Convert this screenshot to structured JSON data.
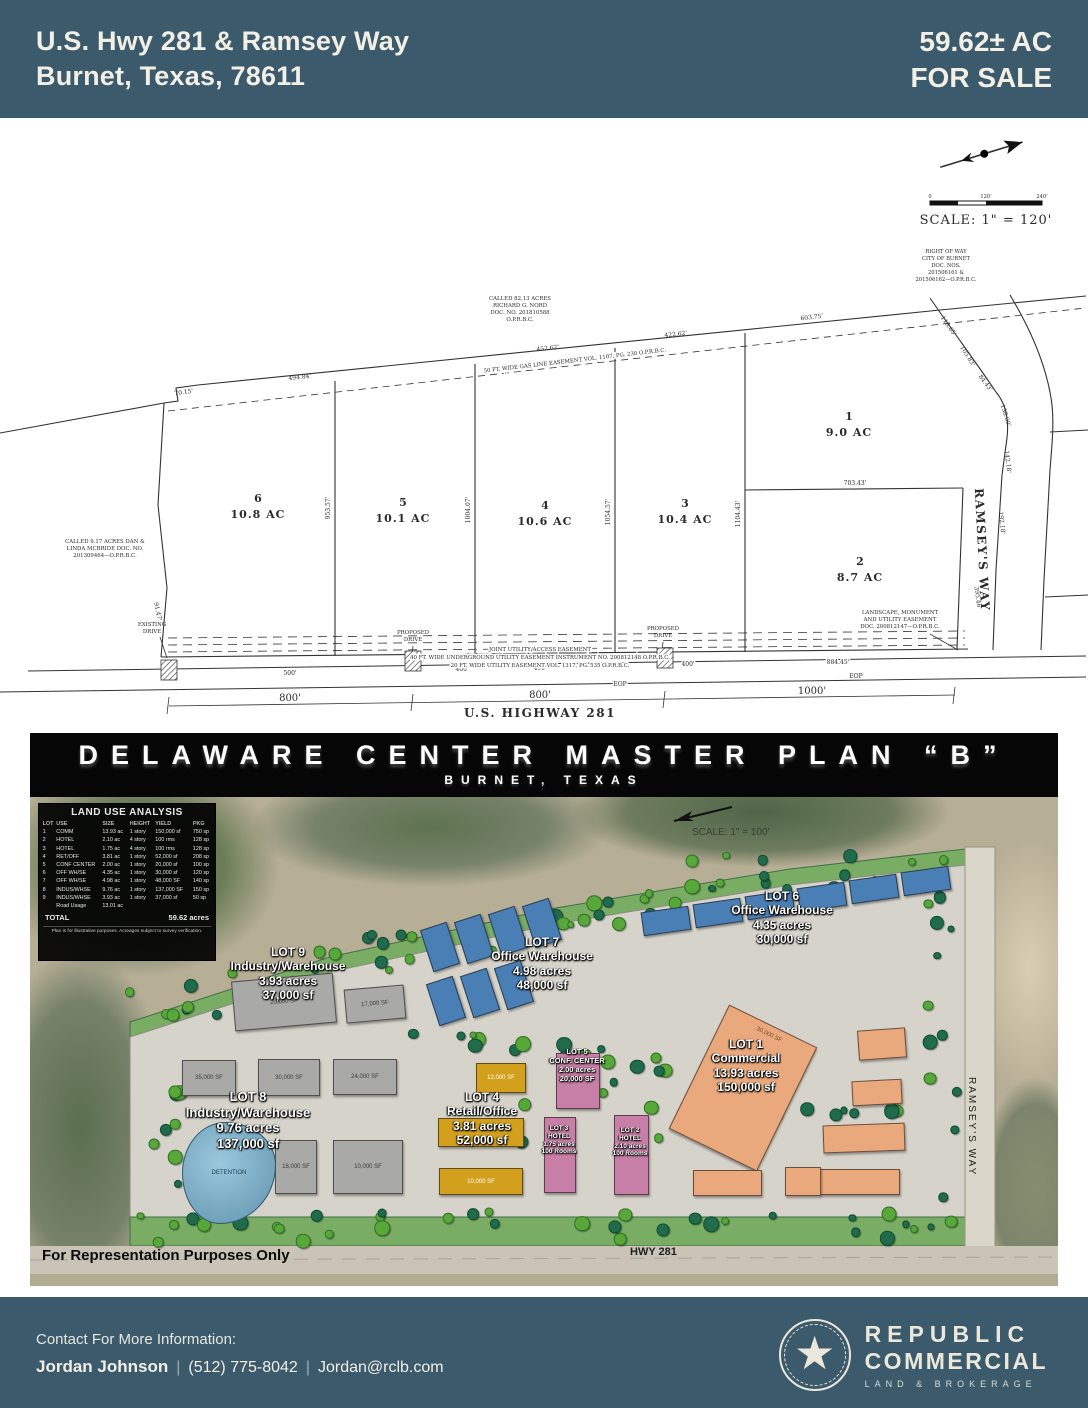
{
  "colors": {
    "band": "#3b5a6c",
    "banner": "#060606",
    "cream": "#f2efe5"
  },
  "header": {
    "address_line1": "U.S. Hwy 281 & Ramsey Way",
    "address_line2": "Burnet, Texas, 78611",
    "acreage": "59.62± AC",
    "for_sale": "FOR SALE"
  },
  "survey": {
    "scale": {
      "zero": "0",
      "mid": "120'",
      "end": "240'",
      "label": "SCALE: 1\" = 120'"
    },
    "row_note": [
      "RIGHT OF WAY",
      "CITY OF BURNET",
      "DOC. NOS.",
      "201506161 &",
      "201506162—O.P.R.B.C."
    ],
    "nord_note": [
      "CALLED 82.13 ACRES",
      "RICHARD G. NORD",
      "DOC. NO. 201810588",
      "O.P.R.B.C."
    ],
    "mcbride_note": [
      "CALLED 9.17 ACRES DAN &",
      "LINDA MCBRIDE DOC. NO.",
      "201309464—O.P.R.B.C."
    ],
    "gas_easement": "50 FT. WIDE GAS LINE EASEMENT VOL. 1107, PG. 230 O.P.R.B.C.",
    "landscape_easement": [
      "LANDSCAPE, MONUMENT",
      "AND UTILITY EASEMENT",
      "DOC. 200812147—O.P.R.B.C."
    ],
    "joint_easement": "JOINT UTILITY/ACCESS EASEMENT",
    "underground_easement": "40 FT. WIDE UNDERGROUND UTILITY EASEMENT INSTRUMENT NO. 200812148 O.P.R.B.C.",
    "utility_easement": "20 FT. WIDE UTILITY EASEMENT VOL. 1317, PG. 535 O.P.R.B.C.",
    "existing_drive": [
      "EXISTING",
      "DRIVE"
    ],
    "proposed_drive": [
      "PROPOSED",
      "DRIVE"
    ],
    "highway_label": "U.S. HIGHWAY 281",
    "ramsey_label": "RAMSEY'S  WAY",
    "eop": "EOP",
    "lots": [
      {
        "num": "1",
        "ac": "9.0  AC"
      },
      {
        "num": "2",
        "ac": "8.7  AC"
      },
      {
        "num": "3",
        "ac": "10.4  AC"
      },
      {
        "num": "4",
        "ac": "10.6  AC"
      },
      {
        "num": "5",
        "ac": "10.1  AC"
      },
      {
        "num": "6",
        "ac": "10.8  AC"
      }
    ],
    "dims": {
      "top1": "494.84'",
      "top2": "452.62'",
      "top3": "422.62'",
      "top4": "603.75'",
      "v1": "953.57'",
      "v2": "1004.07'",
      "v3": "1054.57'",
      "v4": "1104.43'",
      "lot12": "703.43'",
      "r1": "118.65'",
      "r2": "105.83'",
      "r3": "84.43'",
      "r4": "158.00'",
      "r5": "142.18'",
      "r6": "192.18'",
      "r7": "395.46'",
      "b1": "500'",
      "b2": "400'",
      "b3": "450'",
      "b4": "400'",
      "b5": "884.45'",
      "d800a": "800'",
      "d800b": "800'",
      "d1000": "1000'",
      "left1": "70.15'",
      "left2": "91.47'"
    }
  },
  "banner": {
    "title": "DELAWARE CENTER MASTER PLAN “B”",
    "subtitle": "BURNET, TEXAS"
  },
  "siteplan": {
    "land_use": {
      "title": "LAND USE ANALYSIS",
      "all_rows": [
        [
          "LOT",
          "USE",
          "SIZE",
          "HEIGHT",
          "YIELD",
          "PKG"
        ],
        [
          "1",
          "COMM",
          "13.93 ac",
          "1 story",
          "150,000 sf",
          "750 sp"
        ],
        [
          "2",
          "HOTEL",
          "2.10 ac",
          "4 story",
          "100 rms",
          "128 sp"
        ],
        [
          "3",
          "HOTEL",
          "1.75 ac",
          "4 story",
          "100 rms",
          "128 sp"
        ],
        [
          "4",
          "RET/OFF",
          "3.81 ac",
          "1 story",
          "52,000 sf",
          "208 sp"
        ],
        [
          "5",
          "CONF CENTER",
          "2.00 ac",
          "1 story",
          "20,000 sf",
          "100 sp"
        ],
        [
          "6",
          "OFF WH/SE",
          "4.35 ac",
          "1 story",
          "30,000 sf",
          "120 sp"
        ],
        [
          "7",
          "OFF WH/SE",
          "4.98 ac",
          "1 story",
          "48,000 SF",
          "140 sp"
        ],
        [
          "8",
          "INDUS/WHSE",
          "9.76 ac",
          "1 story",
          "137,000 SF",
          "150 sp"
        ],
        [
          "9",
          "INDUS/WHSE",
          "3.93 ac",
          "1 story",
          "37,000 sf",
          "50 sp"
        ],
        [
          "",
          "Road Usage",
          "13.01 ac",
          "",
          "",
          ""
        ]
      ],
      "total_label": "TOTAL",
      "total_value": "59.62 acres",
      "footnote": "Plan is for illustrative purposes. Acreages subject to survey verification."
    },
    "lots": [
      {
        "name": "LOT 1",
        "use": "Commercial",
        "size": "13.93 acres",
        "yield": "150,000 sf"
      },
      {
        "name": "LOT 2",
        "use": "HOTEL",
        "size": "2.10 acres",
        "yield": "100 Rooms"
      },
      {
        "name": "LOT 3",
        "use": "HOTEL",
        "size": "1.75 acres",
        "yield": "100 Rooms"
      },
      {
        "name": "LOT 4",
        "use": "Retail/Office",
        "size": "3.81 acres",
        "yield": "52,000 sf"
      },
      {
        "name": "LOT 5",
        "use": "CONF. CENTER",
        "size": "2.00 acres",
        "yield": "20,000 SF"
      },
      {
        "name": "LOT 6",
        "use": "Office Warehouse",
        "size": "4.35 acres",
        "yield": "30,000 sf"
      },
      {
        "name": "LOT 7",
        "use": "Office Warehouse",
        "size": "4.98 acres",
        "yield": "48,000 sf"
      },
      {
        "name": "LOT 8",
        "use": "Industry/Warehouse",
        "size": "9.76 acres",
        "yield": "137,000 sf"
      },
      {
        "name": "LOT 9",
        "use": "Industry/Warehouse",
        "size": "3.93 acres",
        "yield": "37,000 sf"
      }
    ],
    "buildings": {
      "b20a": "20,000 SF",
      "b17": "17,000 SF",
      "b35": "35,000 SF",
      "b30": "30,000 SF",
      "b24": "24,000 SF",
      "b18": "18,000 SF",
      "b10a": "10,000 SF",
      "b12": "12,000 SF",
      "b10b": "10,000 SF",
      "b30big": "30,000 SF"
    },
    "detention_label": "DETENTION",
    "road_label": "HWY 281",
    "ramsey_label": "RAMSEY'S WAY",
    "scale_text": "SCALE: 1\" = 100'",
    "disclaimer": "For Representation Purposes Only"
  },
  "footer": {
    "heading": "Contact For More Information:",
    "name": "Jordan Johnson",
    "separator": "|",
    "phone": "(512) 775-8042",
    "email": "Jordan@rclb.com",
    "brand_line1": "REPUBLIC",
    "brand_line2": "COMMERCIAL",
    "brand_line3": "LAND & BROKERAGE"
  }
}
